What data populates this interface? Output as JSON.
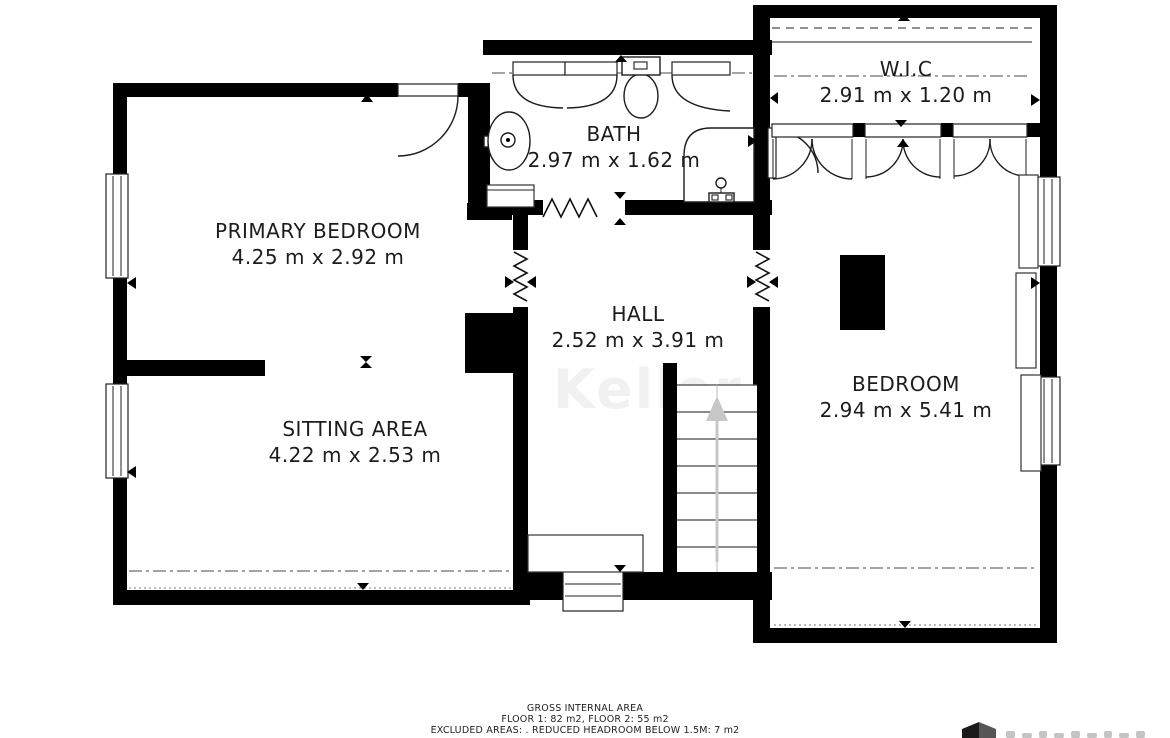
{
  "rooms": [
    {
      "name": "PRIMARY BEDROOM",
      "dimensions": "4.25 m x 2.92 m"
    },
    {
      "name": "SITTING AREA",
      "dimensions": "4.22 m x 2.53 m"
    },
    {
      "name": "BATH",
      "dimensions": "2.97 m x 1.62 m"
    },
    {
      "name": "HALL",
      "dimensions": "2.52 m x 3.91 m"
    },
    {
      "name": "W.I.C",
      "dimensions": "2.91 m x 1.20 m"
    },
    {
      "name": "BEDROOM",
      "dimensions": "2.94 m x 5.41 m"
    }
  ],
  "footer": {
    "line1": "GROSS INTERNAL AREA",
    "line2": "FLOOR 1: 82 m2, FLOOR 2: 55 m2",
    "line3": "EXCLUDED AREAS: . REDUCED HEADROOM BELOW 1.5M: 7 m2"
  },
  "watermark": "Keller",
  "colors": {
    "wall": "#000000",
    "line": "#1c1c1c",
    "dash_line": "#4a4a4a",
    "stairs_arrow": "#c7c7c7",
    "text": "#1c1c1c",
    "background": "#ffffff"
  }
}
